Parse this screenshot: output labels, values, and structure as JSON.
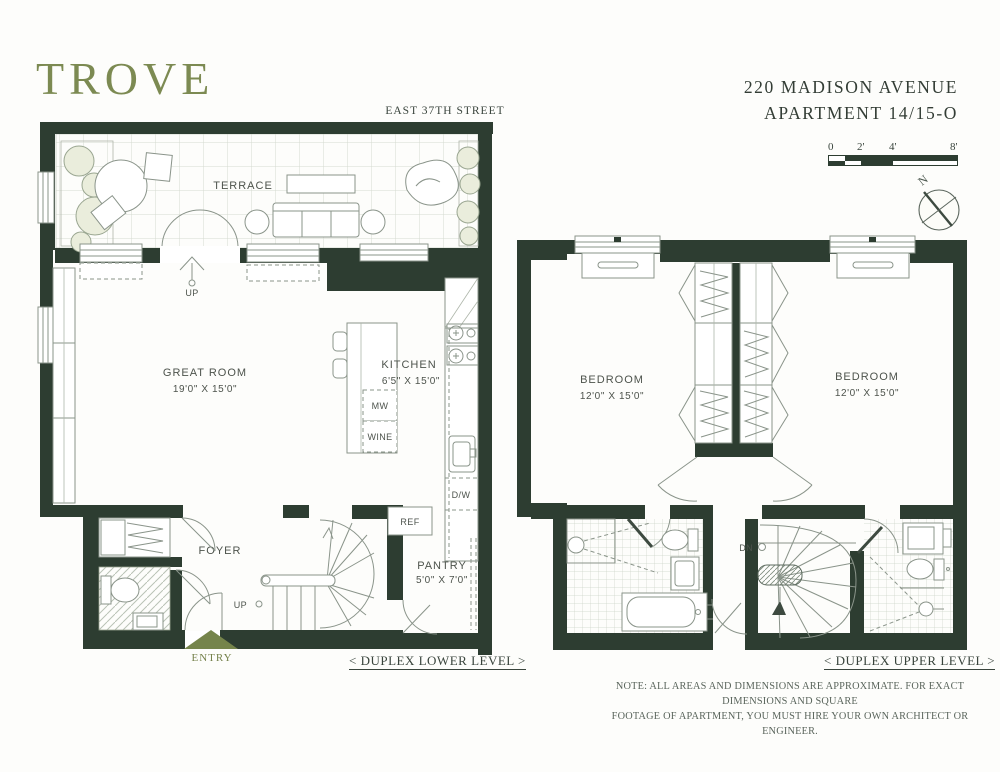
{
  "brand": {
    "logo": "TROVE"
  },
  "header": {
    "address_line1": "220 MADISON AVENUE",
    "address_line2": "APARTMENT 14/15-O"
  },
  "street_label": "EAST 37TH STREET",
  "scale_bar": {
    "labels": [
      "0",
      "2'",
      "4'",
      "8'"
    ]
  },
  "compass": {
    "north_label": "N"
  },
  "lower_level": {
    "caption": "< DUPLEX LOWER LEVEL >",
    "rooms": {
      "terrace": {
        "name": "TERRACE"
      },
      "great_room": {
        "name": "GREAT ROOM",
        "dims": "19'0\" X 15'0\""
      },
      "kitchen": {
        "name": "KITCHEN",
        "dims": "6'5\" X 15'0\""
      },
      "foyer": {
        "name": "FOYER"
      },
      "pantry": {
        "name": "PANTRY",
        "dims": "5'0\" X 7'0\""
      }
    },
    "appliances": {
      "mw": "MW",
      "wine": "WINE",
      "dw": "D/W",
      "ref": "REF"
    },
    "terrace_stairs_label": "UP",
    "stairs_label": "UP",
    "entry_label": "ENTRY"
  },
  "upper_level": {
    "caption": "< DUPLEX UPPER LEVEL >",
    "rooms": {
      "bedroom_left": {
        "name": "BEDROOM",
        "dims": "12'0\" X 15'0\""
      },
      "bedroom_right": {
        "name": "BEDROOM",
        "dims": "12'0\" X 15'0\""
      }
    },
    "stairs_label": "DN"
  },
  "note": {
    "line1": "NOTE: ALL AREAS AND DIMENSIONS ARE APPROXIMATE. FOR EXACT DIMENSIONS AND SQUARE",
    "line2": "FOOTAGE OF APARTMENT, YOU MUST HIRE YOUR OWN ARCHITECT OR ENGINEER."
  },
  "colors": {
    "wall": "#2d3d31",
    "brand_olive": "#7c8a52",
    "entry_arrow": "#75844b"
  }
}
